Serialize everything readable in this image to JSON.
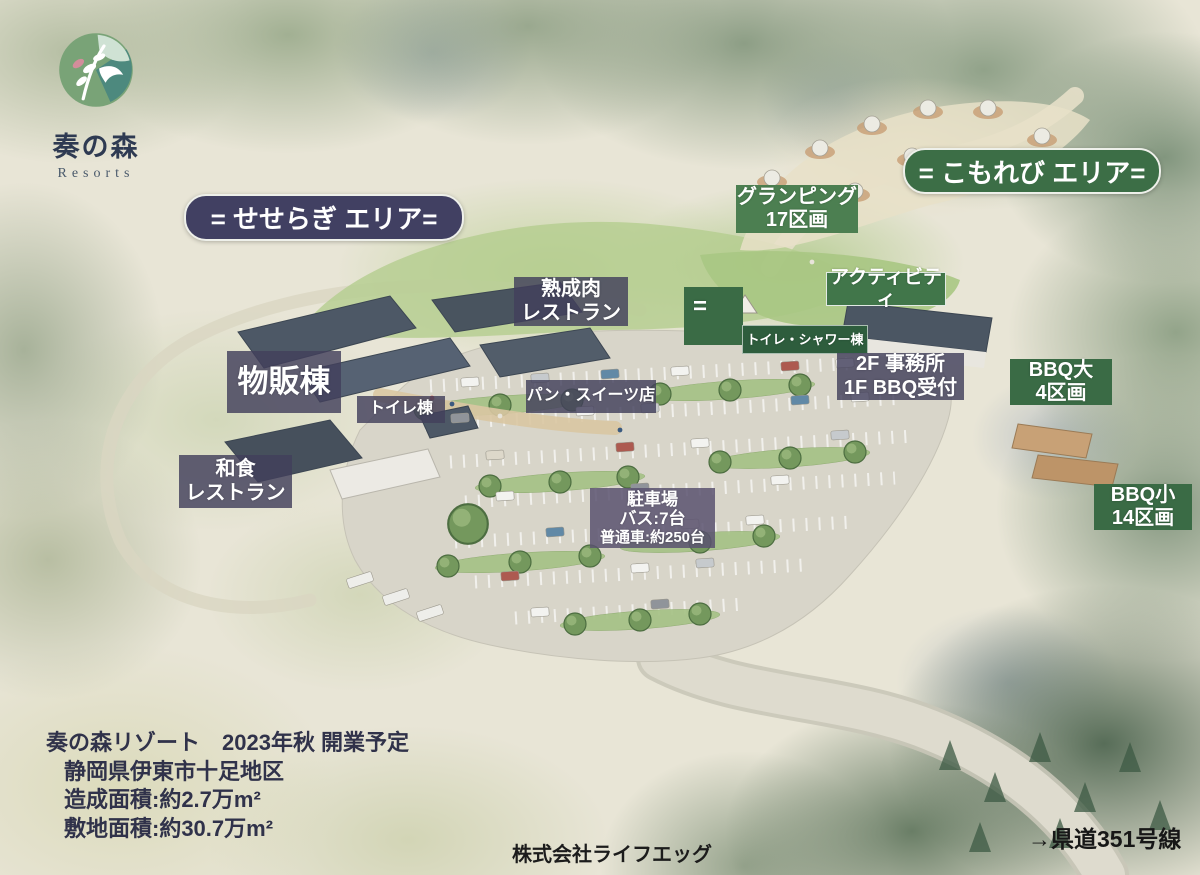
{
  "logo": {
    "name": "奏の森",
    "subtitle": "Resorts"
  },
  "area_banners": {
    "seseragi": "= せせらぎ エリア=",
    "komorebi": "= こもれび エリア="
  },
  "labels": {
    "glamping": {
      "line1": "グランピング",
      "line2": "17区画"
    },
    "activity": {
      "line1": "アクティビティ"
    },
    "aged_meat_restaurant": {
      "line1": "熟成肉",
      "line2": "レストラン"
    },
    "equals_marker": {
      "line1": "="
    },
    "toilet_shower_building": {
      "line1": "トイレ・シャワー棟"
    },
    "office_bbq_reception": {
      "line1": "2F 事務所",
      "line2": "1F BBQ受付"
    },
    "bbq_large": {
      "line1": "BBQ大",
      "line2": "4区画"
    },
    "retail_building": {
      "line1": "物販棟"
    },
    "toilet_building": {
      "line1": "トイレ棟"
    },
    "bakery_sweets_shop": {
      "line1": "パン・スイーツ店"
    },
    "japanese_restaurant": {
      "line1": "和食",
      "line2": "レストラン"
    },
    "parking": {
      "line1": "駐車場",
      "line2": "バス:7台",
      "line3": "普通車:約250台"
    },
    "bbq_small": {
      "line1": "BBQ小",
      "line2": "14区画"
    }
  },
  "footer": {
    "info_lines": [
      "奏の森リゾート　2023年秋 開業予定",
      "静岡県伊東市十足地区",
      "造成面積:約2.7万m²",
      "敷地面積:約30.7万m²"
    ],
    "company": "株式会社ライフエッグ",
    "road_note": "→県道351号線"
  },
  "colors": {
    "banner_navy": "#414062",
    "banner_green": "#3c6e46",
    "label_slate": "rgba(66,64,92,0.82)",
    "label_green": "#3a6b45",
    "parking_label": "rgba(90,82,112,0.85)"
  }
}
